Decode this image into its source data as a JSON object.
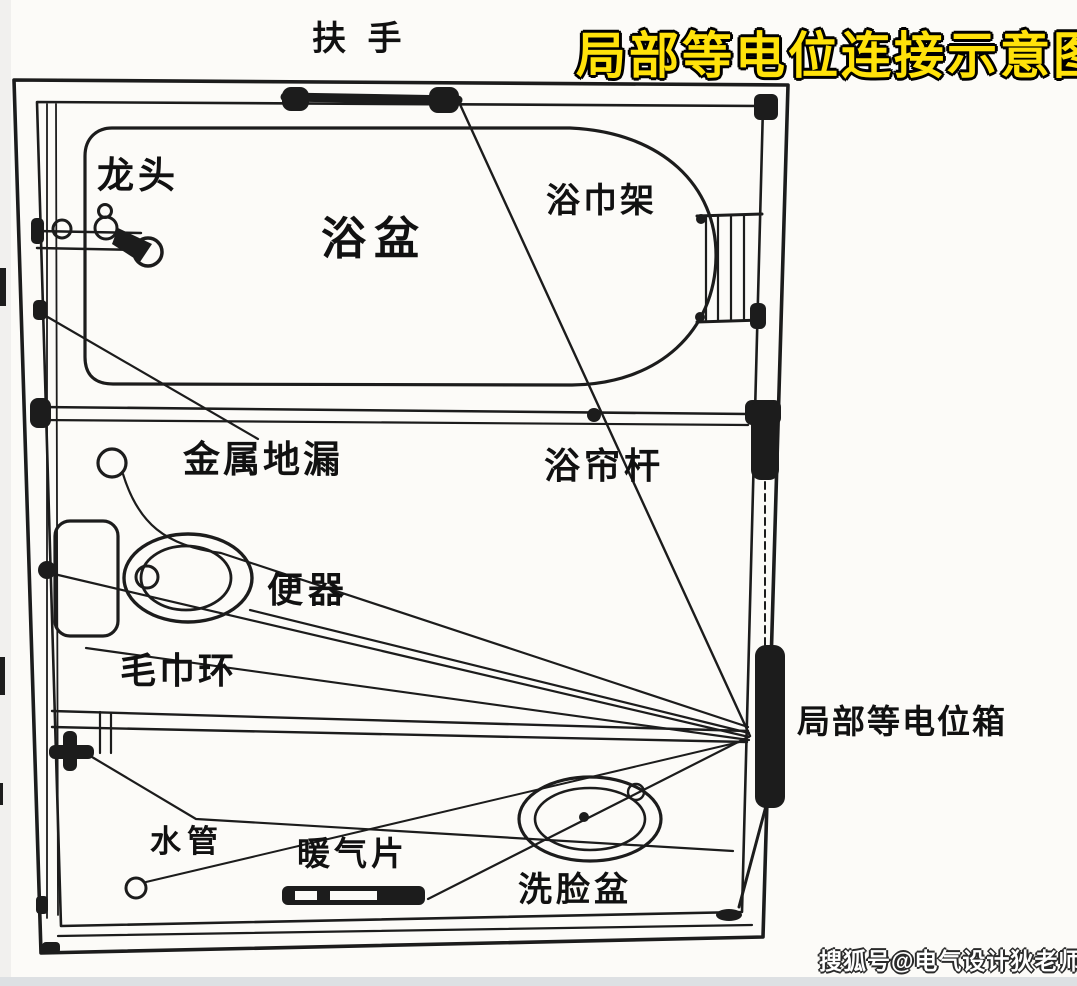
{
  "title": {
    "text": "局部等电位连接示意图",
    "fill_color": "#FFE20A",
    "outline_color": "#000000"
  },
  "watermark": {
    "text": "搜狐号@电气设计狄老师",
    "color": "#ffffff"
  },
  "diagram": {
    "type": "bathroom-local-equipotential-bonding-plan",
    "line_color": "#1c1c1c",
    "paper_color": "#fcfbf8",
    "labels": {
      "handrail": "扶 手",
      "faucet": "龙头",
      "bathtub": "浴盆",
      "towel_rack": "浴巾架",
      "floor_drain": "金属地漏",
      "curtain_rod": "浴帘杆",
      "toilet": "便器",
      "towel_ring": "毛巾环",
      "equipotential_box": "局部等电位箱",
      "water_pipe": "水管",
      "radiator": "暖气片",
      "washbasin": "洗脸盆"
    }
  }
}
